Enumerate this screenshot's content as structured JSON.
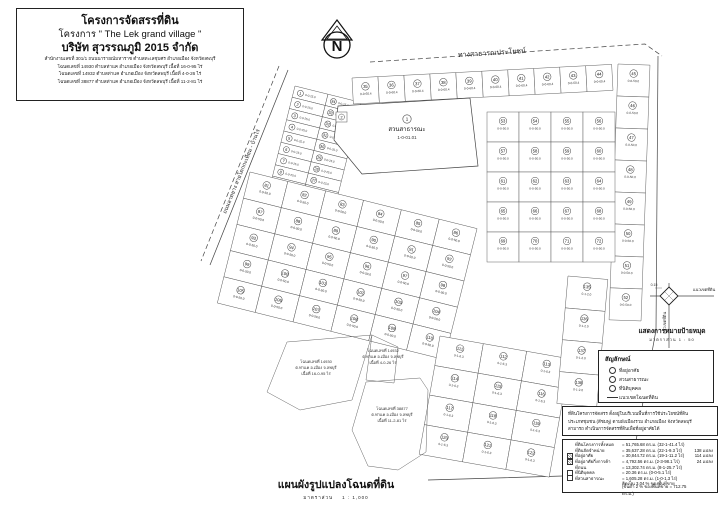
{
  "title_block": {
    "line1": "โครงการจัดสรรที่ดิน",
    "line2": "โครงการ \" The Lek grand village \"",
    "line3": "บริษัท สุวรรณภูมิ 2015 จำกัด",
    "details": [
      "สำนักงานเลขที่ 301/1 ถนนนารายณ์มหาราช ตำบลทะเลชุบศร อำเภอเมือง จังหวัดลพบุรี",
      "โฉนดเลขที่ 14930 ตำบลท่าแค อำเภอเมือง จังหวัดลพบุรี เนื้อที่ 16-0-95 ไร่",
      "โฉนดเลขที่ 14932 ตำบลท่าแค อำเภอเมือง จังหวัดลพบุรี เนื้อที่ 4-0-26 ไร่",
      "โฉนดเลขที่ 38877 ตำบลท่าแค อำเภอเมือง จังหวัดลพบุรี เนื้อที่ 11-2-81 ไร่"
    ]
  },
  "north": {
    "label": "N"
  },
  "map": {
    "road_labels": [
      {
        "text": "ทางสาธารณประโยชน์",
        "x": 492,
        "y": 55,
        "rot": -3.5,
        "size": 7
      },
      {
        "text": "ถนนลาดยาง สายโคกกะเทียม - บ้านไร่",
        "x": 243,
        "y": 172,
        "rot": -68,
        "size": 5.5
      }
    ],
    "shapes": [
      {
        "name": "public-way-line",
        "points": "370,62 645,44 662,56",
        "dash": true
      },
      {
        "name": "east-south-boundary",
        "points": "658,56 656,330 630,474 428,480"
      },
      {
        "name": "west-road-edge",
        "points": "288,70 210,265"
      },
      {
        "name": "west-road-centerline",
        "points": "279,66 201,261",
        "dash": true
      }
    ],
    "blocks": [
      {
        "name": "left-strip",
        "x": 295,
        "y": 86,
        "rot": 14,
        "cols": 2,
        "rows": 17,
        "cw": 34,
        "ch": 11.6,
        "start": 1,
        "scheme": "updown",
        "area": "0-0-25.0",
        "small": true
      },
      {
        "name": "top-row",
        "x": 352,
        "y": 78,
        "rot": -3,
        "cols": 10,
        "rows": 1,
        "cw": 26,
        "ch": 26,
        "start": 35,
        "scheme": "row",
        "area": "0-0-60.4"
      },
      {
        "name": "east-column",
        "x": 618,
        "y": 64,
        "rot": 2,
        "cols": 1,
        "rows": 8,
        "cw": 32,
        "ch": 32,
        "start": 45,
        "scheme": "row",
        "area": "0-0-50.0"
      },
      {
        "name": "east-grid",
        "x": 487,
        "y": 112,
        "rot": 0,
        "cols": 4,
        "rows": 5,
        "cw": 32,
        "ch": 30,
        "start": 53,
        "scheme": "row",
        "area": "0-0-50.0"
      },
      {
        "name": "mid-grid",
        "x": 250,
        "y": 172,
        "rot": 14,
        "cols": 6,
        "rows": 5,
        "cw": 39,
        "ch": 27,
        "start": 81,
        "scheme": "row",
        "area": "0-0-50.0"
      },
      {
        "name": "south-grid",
        "x": 440,
        "y": 336,
        "rot": 10,
        "cols": 3,
        "rows": 4,
        "cw": 44,
        "ch": 30,
        "start": 111,
        "scheme": "row",
        "area": "0-1-6.3"
      },
      {
        "name": "south-column",
        "x": 568,
        "y": 276,
        "rot": 5,
        "cols": 1,
        "rows": 4,
        "cw": 40,
        "ch": 32,
        "start": 135,
        "scheme": "row",
        "area": "0-1-2.0"
      }
    ],
    "park": {
      "points": "338,106 470,98 478,166 362,174 334,140",
      "num": "1",
      "name": "สวนสาธารณะ",
      "area": "1-0-01.01",
      "lx": 407,
      "ly": 130
    },
    "office_lot": {
      "x": 336,
      "y": 112,
      "w": 11,
      "h": 10,
      "num": "2"
    },
    "deeds": [
      {
        "points": "267,392 287,342 372,335 352,400 300,410",
        "lx": 316,
        "ly": 363,
        "lines": [
          "โฉนดเลขที่ 14930",
          "ต.ท่าแค อ.เมือง จ.ลพบุรี",
          "เนื้อที่ 16-0-95 ไร่"
        ]
      },
      {
        "points": "372,335 398,347 394,383 366,380",
        "lx": 383,
        "ly": 352,
        "lines": [
          "โฉนดเลขที่ 14932",
          "ต.ท่าแค อ.เมือง จ.ลพบุรี",
          "เนื้อที่ 4-0-26 ไร่"
        ]
      },
      {
        "points": "366,382 420,378 428,390 426,452 398,470 368,466 352,430",
        "lx": 392,
        "ly": 410,
        "lines": [
          "โฉนดเลขที่ 38877",
          "ต.ท่าแค อ.เมือง จ.ลพบุรี",
          "เนื้อที่ 11-2-81 ไร่"
        ]
      }
    ]
  },
  "corner_detail": {
    "title": "แสดงการหมายป้ายหมุด",
    "scale": "มาตราส่วน   1 : 50",
    "boundary_label_h": "แนวเขตที่ดิน",
    "boundary_label_v": "แนวเขตที่ดิน",
    "dim": "0.15"
  },
  "legend": {
    "title": "สัญลักษณ์",
    "items": [
      {
        "label": "ที่อยู่อาศัย"
      },
      {
        "label": "สวนสาธารณะ"
      },
      {
        "label": "ที่นิติบุคคล"
      },
      {
        "label": "แนวเขตโฉนดที่ดิน"
      }
    ]
  },
  "note": {
    "lines": [
      "ที่ดินโครงการจัดสรร ตั้งอยู่ในบริเวณพื้นที่การใช้ประโยชน์ที่ดิน",
      "ประเภทชุมชน (สีชมพู) ตามผังเมืองรวม อำเภอเมือง จังหวัดลพบุรี",
      "สามารถ ดำเนินการจัดสรรที่ดินเพื่อที่อยู่อาศัยได้"
    ]
  },
  "stats": {
    "rows": [
      {
        "label": "ที่ดินโครงการทั้งหมด",
        "value": "= 51,765.68 ตร.ม. (32-1-41.4 ไร่)",
        "count": ""
      },
      {
        "label": "ที่ดินจัดจำหน่าย",
        "value": "= 35,637.28 ตร.ม. (22-1-9.3 ไร่)",
        "count": "138 แปลง"
      },
      {
        "label": "ที่อยู่อาศัย",
        "value": "= 30,844.72 ตร.ม. (19-1-11.2 ไร่)",
        "count": "114 แปลง"
      },
      {
        "label": "ที่อยู่อาศัยกึ่งการค้า",
        "value": "= 4,792.56 ตร.ม. (2-3-98.1 ไร่)",
        "count": "24 แปลง"
      },
      {
        "label": "ที่ถนน",
        "value": "= 13,302.74 ตร.ม. (8-1-25.7 ไร่)",
        "count": ""
      },
      {
        "label": "ที่นิติบุคคล",
        "value": "= 20.36 ตร.ม. (0-0-5.1 ไร่)",
        "count": ""
      },
      {
        "label": "ที่สวนสาธารณะ",
        "value": "= 1,605.28 ตร.ม. (1-0-1.3 ไร่)",
        "count": ""
      },
      {
        "label": "",
        "value": "คิดเป็น 3.04 % ของพื้นที่ขาย",
        "count": ""
      },
      {
        "label": "",
        "value": "(ขั้นต่ำ 2 % ของพื้นที่ขาย = 712.75 ตร.ม.)",
        "count": ""
      }
    ]
  },
  "footer": {
    "title": "แผนผังรูปแปลงโฉนดที่ดิน",
    "scale_label": "มาตราส่วน",
    "scale_value": "1 : 1,000"
  }
}
